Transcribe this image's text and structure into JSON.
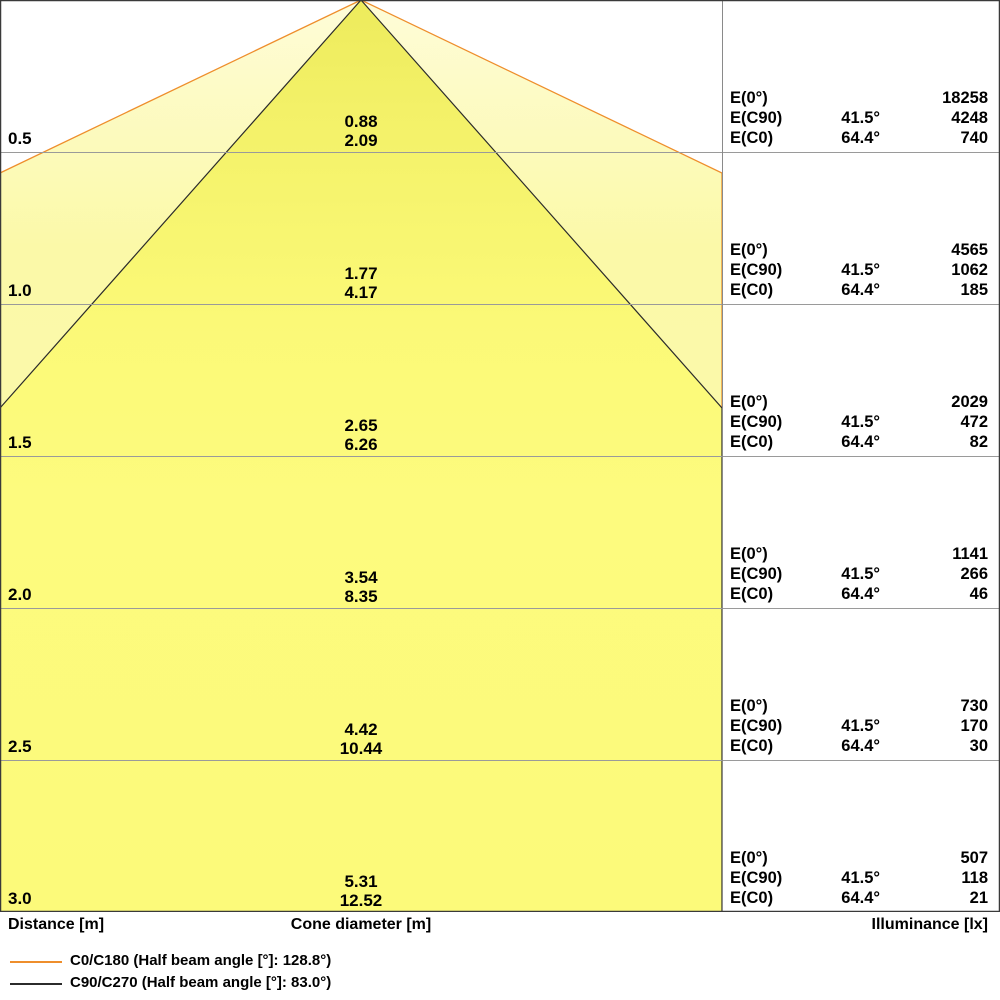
{
  "colors": {
    "outer_cone_line": "#EE8E2C",
    "inner_cone_line": "#2B2B2B",
    "outer_cone_fill": "#FBF9A8",
    "inner_cone_fill": "#FCFA7A",
    "grid_line": "#9A9A9A",
    "border": "#3A3A3A"
  },
  "table_labels": {
    "e0": "E(0°)",
    "ec90": "E(C90)",
    "ec0": "E(C0)"
  },
  "footer": {
    "distance": "Distance [m]",
    "cone_diameter": "Cone diameter [m]",
    "illuminance": "Illuminance [lx]"
  },
  "legend": [
    {
      "color": "#EE8E2C",
      "label": "C0/C180 (Half beam angle [°]: 128.8°)"
    },
    {
      "color": "#2B2B2B",
      "label": "C90/C270 (Half beam angle [°]: 83.0°)"
    }
  ],
  "rows": [
    {
      "distance": "0.5",
      "cone_c90": "0.88",
      "cone_c0": "2.09",
      "e0": "18258",
      "a90": "41.5°",
      "e90": "4248",
      "a0": "64.4°",
      "ec0": "740"
    },
    {
      "distance": "1.0",
      "cone_c90": "1.77",
      "cone_c0": "4.17",
      "e0": "4565",
      "a90": "41.5°",
      "e90": "1062",
      "a0": "64.4°",
      "ec0": "185"
    },
    {
      "distance": "1.5",
      "cone_c90": "2.65",
      "cone_c0": "6.26",
      "e0": "2029",
      "a90": "41.5°",
      "e90": "472",
      "a0": "64.4°",
      "ec0": "82"
    },
    {
      "distance": "2.0",
      "cone_c90": "3.54",
      "cone_c0": "8.35",
      "e0": "1141",
      "a90": "41.5°",
      "e90": "266",
      "a0": "64.4°",
      "ec0": "46"
    },
    {
      "distance": "2.5",
      "cone_c90": "4.42",
      "cone_c0": "10.44",
      "e0": "730",
      "a90": "41.5°",
      "e90": "170",
      "a0": "64.4°",
      "ec0": "30"
    },
    {
      "distance": "3.0",
      "cone_c90": "5.31",
      "cone_c0": "12.52",
      "e0": "507",
      "a90": "41.5°",
      "e90": "118",
      "a0": "64.4°",
      "ec0": "21"
    }
  ],
  "chart_data": {
    "type": "table",
    "title": "Luminaire light cone diagram (cone diameter and illuminance vs distance)",
    "legend_position": "bottom",
    "beam_angles": {
      "c0_c180_half_beam_deg": 128.8,
      "c90_c270_half_beam_deg": 83.0,
      "e_c90_angle_deg": 41.5,
      "e_c0_angle_deg": 64.4
    },
    "columns": [
      "Distance [m]",
      "Cone diameter C90/C270 [m]",
      "Cone diameter C0/C180 [m]",
      "E(0°) [lx]",
      "E(C90) [lx]",
      "E(C0) [lx]"
    ],
    "rows": [
      [
        0.5,
        0.88,
        2.09,
        18258,
        4248,
        740
      ],
      [
        1.0,
        1.77,
        4.17,
        4565,
        1062,
        185
      ],
      [
        1.5,
        2.65,
        6.26,
        2029,
        472,
        82
      ],
      [
        2.0,
        3.54,
        8.35,
        1141,
        266,
        46
      ],
      [
        2.5,
        4.42,
        10.44,
        730,
        170,
        30
      ],
      [
        3.0,
        5.31,
        12.52,
        507,
        118,
        21
      ]
    ]
  }
}
